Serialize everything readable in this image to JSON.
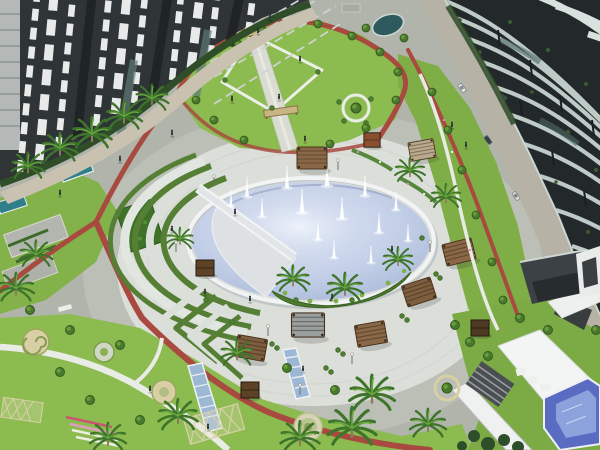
{
  "meta": {
    "type": "architectural-aerial-render",
    "title": "Aerial render of residential compound with circular fountain plaza",
    "description": "Bird's-eye 3D visualization: dark apartment towers (north-west) and a curved tower with wavy white balcony bands (east) surround a landscaped park. Center holds a circular plaza with a large round fountain pool with many water jets, a pie-slice deck notch with a walkway, amphitheater terrace arcs, wooden pergolas, palm trees, lawns, a red jogging track, water-stair channels, and a small blue pool by white club buildings in the south-east."
  },
  "scene": {
    "areas": {
      "northwest": "dark residential towers with white curved balconies and palm-lined promenade",
      "north": "kite-shaped lawn with diamond path, central promenade and two pergola gates",
      "east": "curved dark tower with wavy light balcony bands beside an access road",
      "center": "circular plaza deck with round fountain pool, notch walkway and island planting bed",
      "west": "terraced amphitheater arcs and chevron planting beds",
      "southwest": "gardens with winding paths, round flower beds, lattice trellises",
      "southeast": "white club buildings, stair block and blue swimming pool"
    },
    "counts": {
      "fountain_jets": 14,
      "pergolas": 7,
      "kiosks": 4,
      "pergola_gates": 2,
      "terrace_arcs": 6,
      "chevron_terraces": 4,
      "water_channels": 2,
      "garden_circles": 4,
      "vehicles": 3,
      "palm_trees": 22
    }
  },
  "colors": {
    "outer_pavement": "#b0b4ab",
    "outer_ring": "#bcbfb6",
    "plaza_deck": "#dcdfd9",
    "pool_water": "#c5d1e8",
    "pool_rim": "#f1f3f5",
    "lawn_green": "#8cbb50",
    "lawn_mid": "#83b24a",
    "lawn_dark": "#7fae47",
    "lawn_se": "#7cab45",
    "hedge_green": "#3c6a2c",
    "track_red": "#a84a3f",
    "path_beige": "#c9c2b0",
    "facade_nw": "#2f3436",
    "facade_dark": "#23282a",
    "facade_band": "#c7d3cf",
    "balcony_white": "#e8ebe9",
    "wood_brown": "#8a6847",
    "kiosk_brown": "#5d4226",
    "water_channel": "#9db8d4",
    "se_pool_blue": "#5a6cc2",
    "white_roof": "#f3f5f4",
    "teal_pool": "#2f7f8a",
    "garden_bed_tan": "#d8cfa4"
  }
}
